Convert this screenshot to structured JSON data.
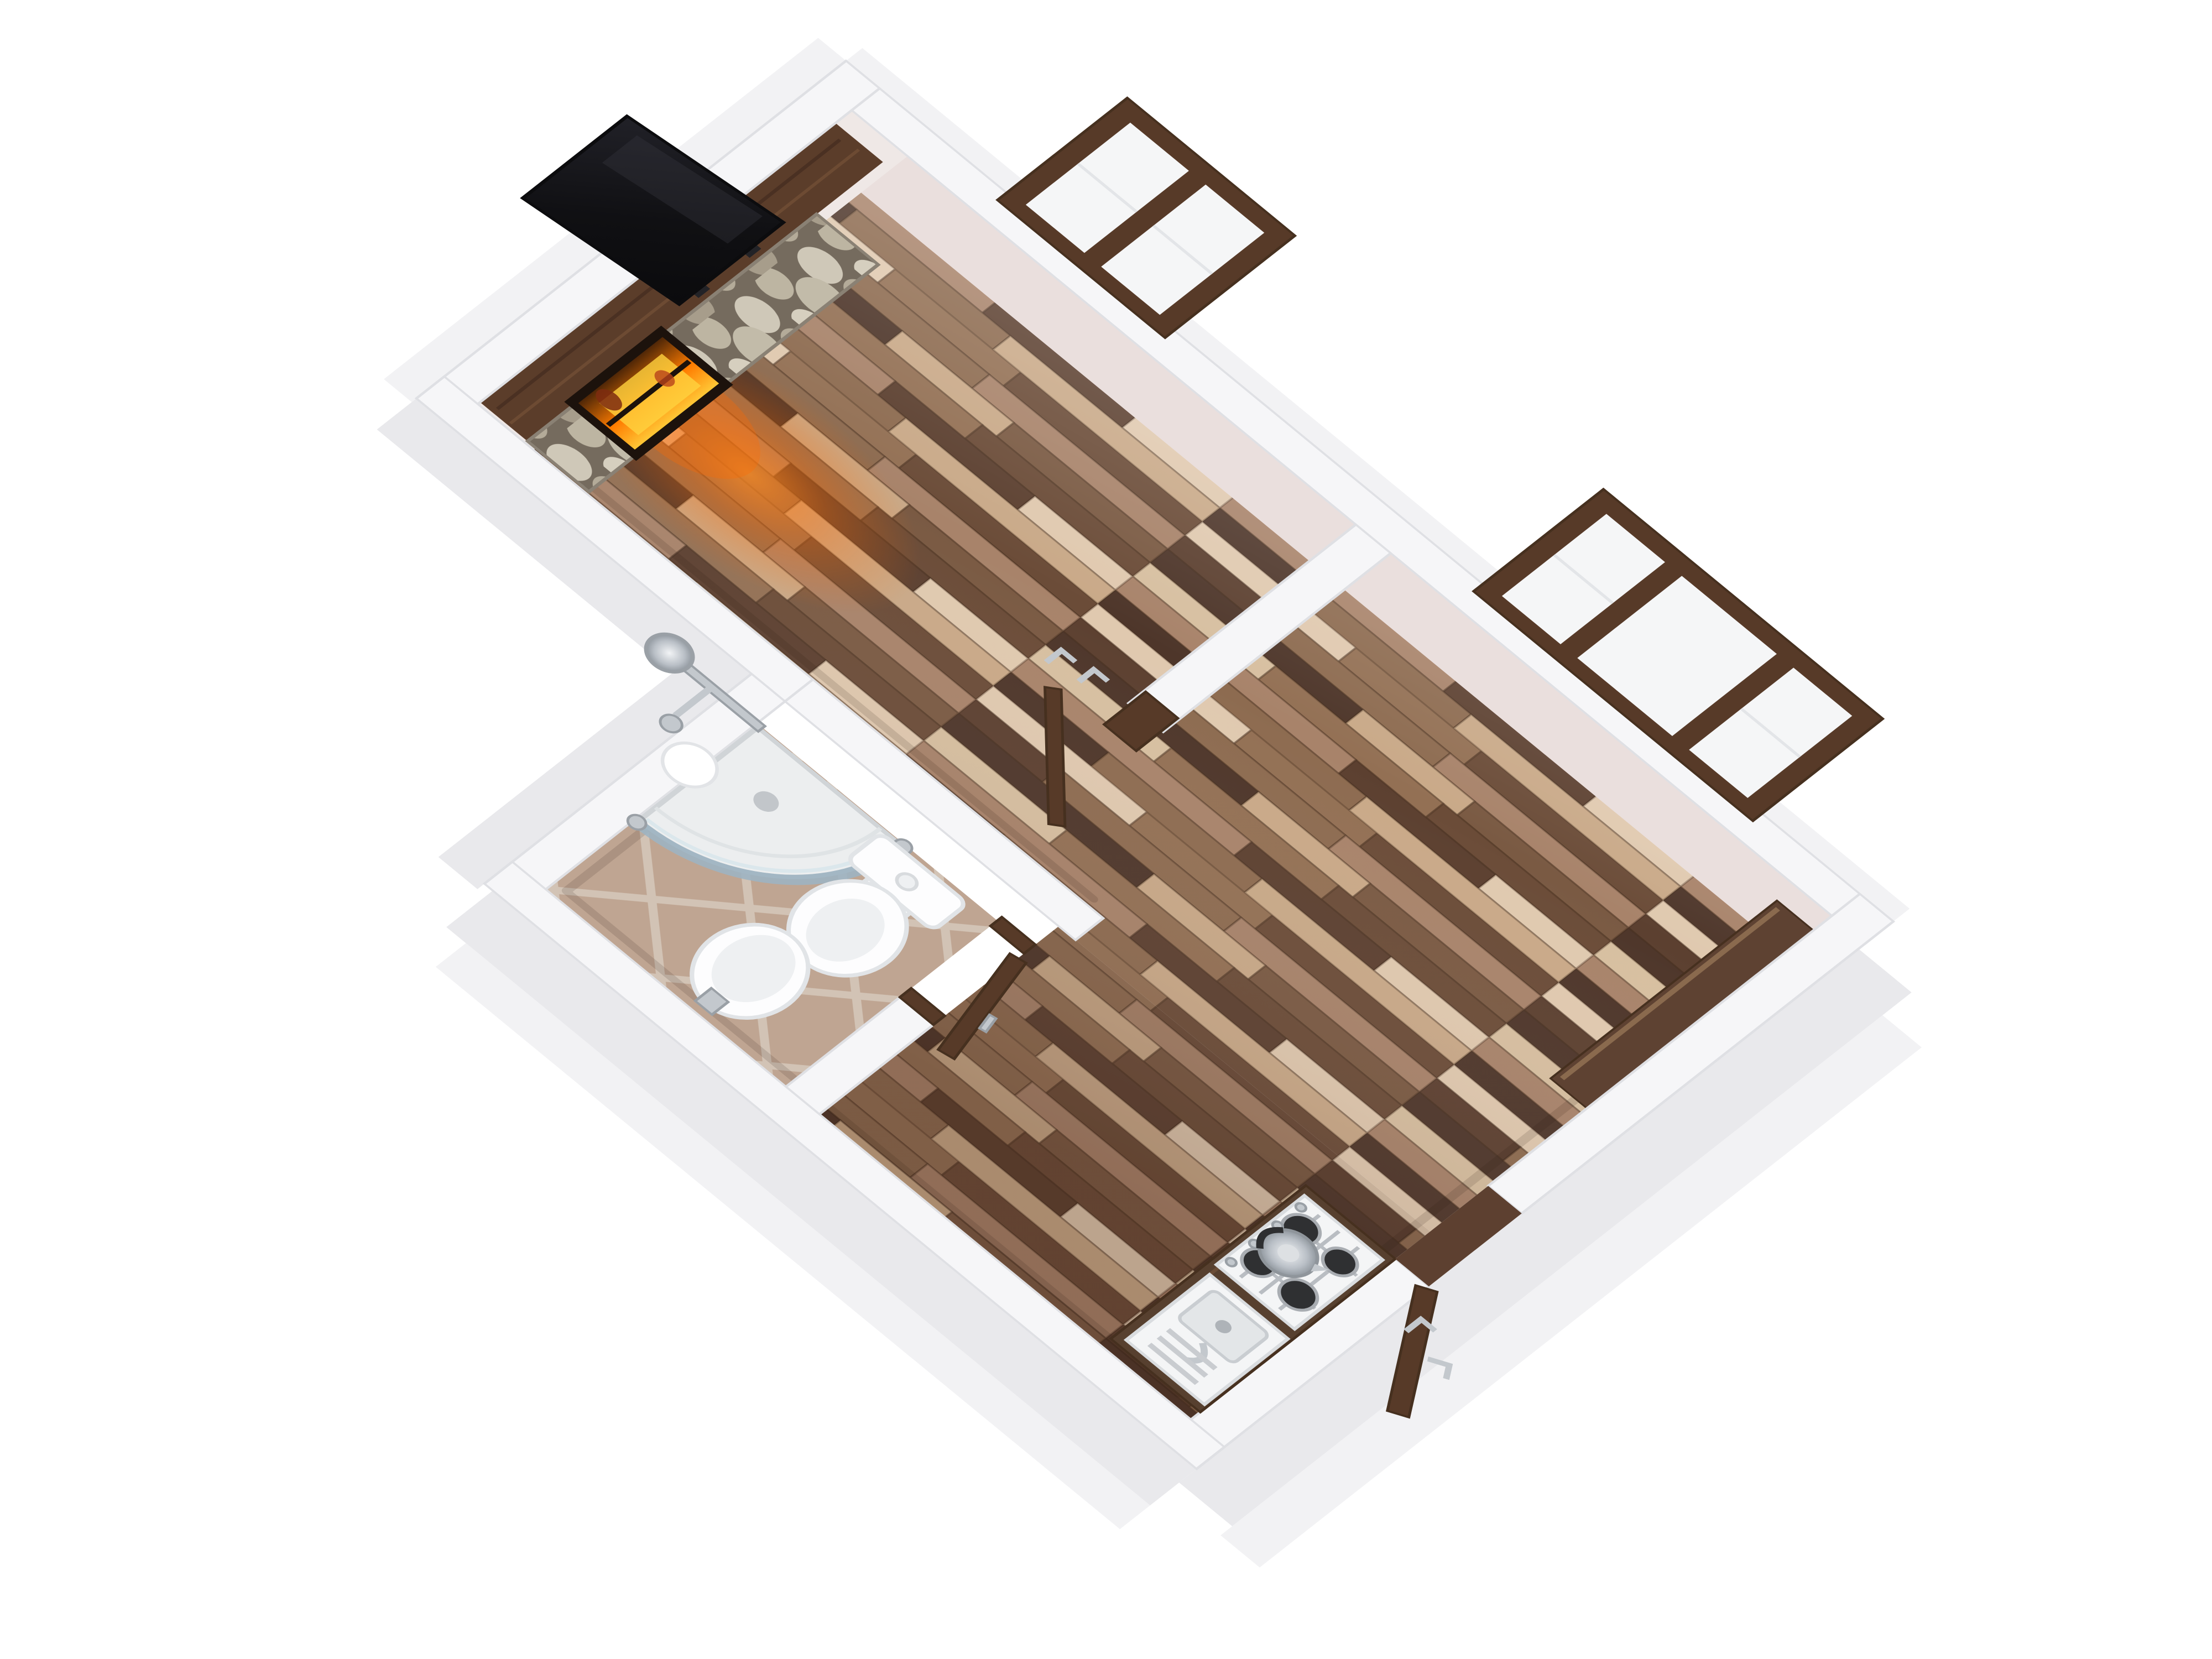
{
  "meta": {
    "title": "3D rendered floor plan of a studio apartment, top-down axonometric view",
    "view": "axonometric top-down, rotated ~40 degrees",
    "background": "#ffffff"
  },
  "colors": {
    "wall": "#f6f6f8",
    "wall_edge": "#dfe0e4",
    "wall_outer": "#e9e9ec",
    "wall_outer_light": "#f2f2f4",
    "wall_inner_ne": "#eadfdd",
    "wall_inner_nw": "#efe8e6",
    "beam": "#5b3d2a",
    "beam_dark": "#46301f",
    "door_wood": "#573a28",
    "counter_wood": "#57402f",
    "threshold": "#5d4030",
    "ledge": "#5e4232",
    "wood0": "#7a5a43",
    "wood1": "#937054",
    "wood2": "#5c4030",
    "wood3": "#a8836a",
    "wood4": "#e0c9af",
    "wood5": "#6b4c38",
    "wood6": "#8d6b50",
    "wood7": "#4e362a",
    "wood8": "#c9a988",
    "wood9": "#d7bfa0",
    "tile_base": "#c3a996",
    "tile_grout": "#d7c9bb",
    "stone_bg": "#756b5e",
    "stone_a": "#cfc8b8",
    "stone_b": "#b4ab99",
    "stone_c": "#c2bba9",
    "stone_d": "#a79d8b",
    "stone_e": "#bdb5a2",
    "stone_f": "#d6cfbf",
    "ceramic": "#fdfdfe",
    "ceramic_shadow": "#e1e4e7",
    "ceramic_inner": "#eef0f2",
    "chrome": "#c3c8cd",
    "chrome_dark": "#9aa0a6",
    "glass_pane": "#f5f6f7",
    "glass_shower": "#9db4c2",
    "tv_dark": "#141416",
    "fire_glow": "#ff6a00",
    "fire_mid": "#ff7c00",
    "fire_core": "#ffd23e"
  },
  "scene": {
    "rooms": [
      {
        "name": "living-room",
        "floor": "wood parquet planks",
        "features": [
          "stone-clad fireplace with glowing firebox",
          "flat TV on wood mantel beam",
          "double casement window",
          "warm glow on floor"
        ]
      },
      {
        "name": "second-room",
        "floor": "wood parquet planks",
        "features": [
          "triple window",
          "wood ledge along end wall",
          "partition wall with open interior door"
        ]
      },
      {
        "name": "bathroom",
        "floor": "beige ceramic tile laid diagonally",
        "fixtures": [
          "corner shower with curved glass enclosure",
          "chrome shower column",
          "toilet",
          "bidet",
          "round wall soap dish",
          "open wood door"
        ]
      },
      {
        "name": "kitchen-nook",
        "floor": "wood parquet planks",
        "fixtures": [
          "dark wood counter",
          "white gas hob with 4 burners",
          "chrome kettle",
          "sink with drainboard and chrome faucet"
        ]
      }
    ],
    "doors": [
      {
        "name": "entry-door",
        "state": "open outward",
        "material": "dark wood",
        "hardware": "chrome lever handle"
      },
      {
        "name": "bathroom-door",
        "state": "open into kitchen corridor",
        "material": "dark wood"
      },
      {
        "name": "interior-door",
        "state": "open, standing in partition doorway",
        "hardware": "two chrome lever handles"
      }
    ],
    "windows": [
      {
        "name": "double-window",
        "panes": 2,
        "frame": "dark wood"
      },
      {
        "name": "triple-window",
        "panes": 3,
        "frame": "dark wood"
      }
    ]
  }
}
